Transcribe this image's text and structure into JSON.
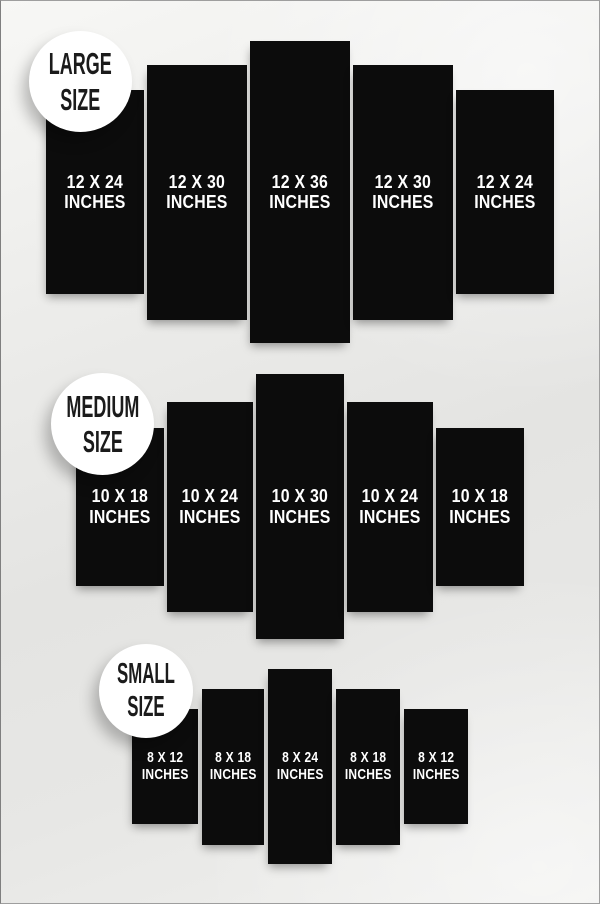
{
  "title": "Canvas Panel Size Chart",
  "colors": {
    "background_light": "#f7f7f5",
    "background_dark": "#e4e4e2",
    "panel": "#0c0c0c",
    "panel_text": "#ffffff",
    "badge_background": "#ffffff",
    "badge_text": "#1b1b1b"
  },
  "groups": [
    {
      "id": "large",
      "badge": {
        "line1": "LARGE",
        "line2": "SIZE"
      },
      "panels": [
        {
          "size": "12 X 24",
          "unit": "INCHES"
        },
        {
          "size": "12 X 30",
          "unit": "INCHES"
        },
        {
          "size": "12 X 36",
          "unit": "INCHES"
        },
        {
          "size": "12 X 30",
          "unit": "INCHES"
        },
        {
          "size": "12 X 24",
          "unit": "INCHES"
        }
      ]
    },
    {
      "id": "medium",
      "badge": {
        "line1": "MEDIUM",
        "line2": "SIZE"
      },
      "panels": [
        {
          "size": "10 X 18",
          "unit": "INCHES"
        },
        {
          "size": "10 X 24",
          "unit": "INCHES"
        },
        {
          "size": "10 X 30",
          "unit": "INCHES"
        },
        {
          "size": "10 X 24",
          "unit": "INCHES"
        },
        {
          "size": "10 X 18",
          "unit": "INCHES"
        }
      ]
    },
    {
      "id": "small",
      "badge": {
        "line1": "SMALL",
        "line2": "SIZE"
      },
      "panels": [
        {
          "size": "8 X 12",
          "unit": "INCHES"
        },
        {
          "size": "8 X 18",
          "unit": "INCHES"
        },
        {
          "size": "8 X 24",
          "unit": "INCHES"
        },
        {
          "size": "8 X 18",
          "unit": "INCHES"
        },
        {
          "size": "8 X 12",
          "unit": "INCHES"
        }
      ]
    }
  ]
}
